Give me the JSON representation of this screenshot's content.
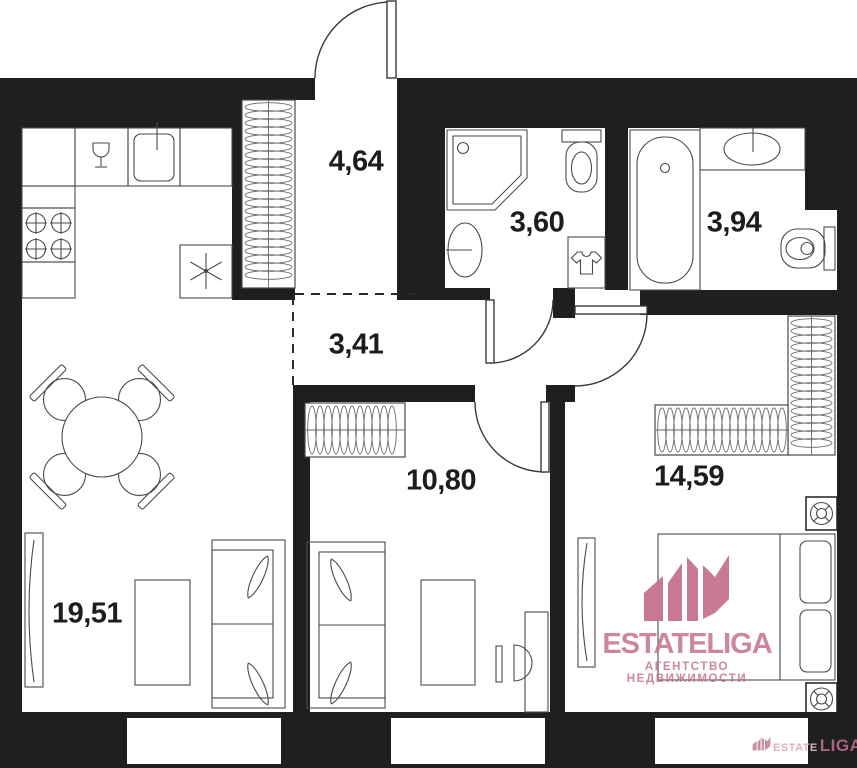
{
  "plan": {
    "rooms": [
      {
        "id": "entrance-hall",
        "area": "4,64"
      },
      {
        "id": "bathroom-shower",
        "area": "3,60"
      },
      {
        "id": "bathroom-tub",
        "area": "3,94"
      },
      {
        "id": "corridor",
        "area": "3,41"
      },
      {
        "id": "room-small",
        "area": "10,80"
      },
      {
        "id": "bedroom",
        "area": "14,59"
      },
      {
        "id": "living-kitchen",
        "area": "19,51"
      }
    ]
  },
  "watermark": {
    "brand": "ESTATELIGA",
    "tagline": "АГЕНТСТВО НЕДВИЖИМОСТИ",
    "corner_brand_part1": "ESTATE",
    "corner_brand_part2": "LIGA"
  },
  "colors": {
    "wall": "#1f1f1f",
    "furniture_line": "#4a4a4a",
    "door_line": "#3a3a3a",
    "label_text": "#1d1d1d",
    "accent_pink": "#c4718e",
    "background": "#ffffff"
  },
  "icons": {
    "crown-logo-icon": "stylized castle crown",
    "stove-burners-icon": "four crossed circles",
    "wine-glass-icon": "stemware glyph",
    "kitchen-sink-icon": "rounded square with tap",
    "fridge-snowflake-icon": "six-ray asterisk",
    "shower-icon": "corner tray with drain",
    "toilet-icon": "tank and bowl",
    "washing-machine-icon": "square with t-shirt",
    "bathtub-icon": "oval tub",
    "basin-icon": "oval sink",
    "dining-set-icon": "round table with four chairs",
    "sofa-icon": "two-seat sofa with cushions",
    "bed-icon": "double bed with pillows",
    "desk-chair-icon": "desk with half-round chair",
    "wardrobe-icon": "coil-hatched closet",
    "vent-icon": "square with spoked circle",
    "door-arc-icon": "door leaf with swing arc",
    "window-icon": "tall casement with curve"
  }
}
